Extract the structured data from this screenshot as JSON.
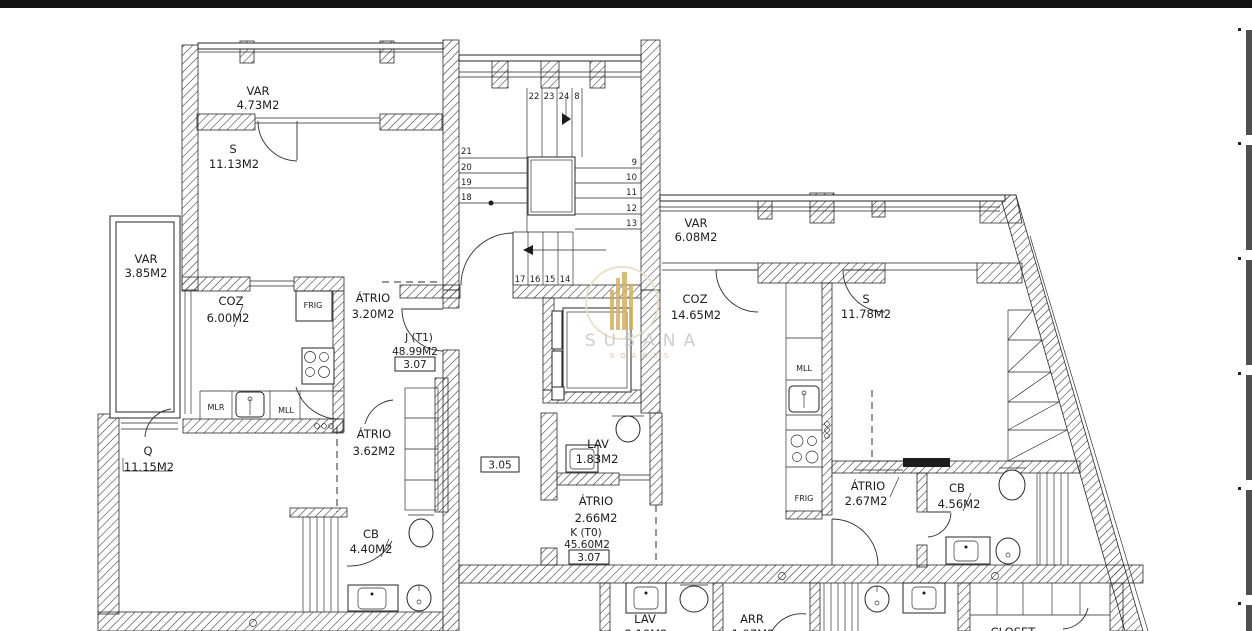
{
  "frame": {
    "top_bar_color": "#131313",
    "edge_mark_color": "#4f4f4f"
  },
  "watermark": {
    "name": "SUSANA",
    "subname": "SOARES",
    "accent": "#d2b263",
    "ring": "#e6dcc2",
    "text_color": "#bfbfbf"
  },
  "units": {
    "j": {
      "label": "J (T1)",
      "area": "48.99M2",
      "door_tag": "3.07"
    },
    "k": {
      "label": "K (T0)",
      "area": "45.60M2",
      "door_tag": "3.07"
    }
  },
  "corridor": {
    "door_tag": "3.05"
  },
  "rooms": {
    "var_top_left": {
      "name": "VAR",
      "area": "4.73M2"
    },
    "s_top_left": {
      "name": "S",
      "area": "11.13M2"
    },
    "var_left": {
      "name": "VAR",
      "area": "3.85M2"
    },
    "coz_left": {
      "name": "COZ",
      "area": "6.00M2"
    },
    "atrio_entry_left": {
      "name": "ÁTRIO",
      "area": "3.20M2"
    },
    "q_left": {
      "name": "Q",
      "area": "11.15M2"
    },
    "atrio_inner_left": {
      "name": "ÁTRIO",
      "area": "3.62M2"
    },
    "cb_left": {
      "name": "CB",
      "area": "4.40M2"
    },
    "var_right": {
      "name": "VAR",
      "area": "6.08M2"
    },
    "coz_right": {
      "name": "COZ",
      "area": "14.65M2"
    },
    "s_right": {
      "name": "S",
      "area": "11.78M2"
    },
    "lav_center": {
      "name": "LAV",
      "area": "1.83M2"
    },
    "atrio_center": {
      "name": "ÁTRIO",
      "area": "2.66M2"
    },
    "atrio_right": {
      "name": "ÁTRIO",
      "area": "2.67M2"
    },
    "cb_right": {
      "name": "CB",
      "area": "4.56M2"
    },
    "lav_bottom": {
      "name": "LAV",
      "area": "2.18M2"
    },
    "arr_bottom": {
      "name": "ARR",
      "area": "1.97M2"
    },
    "closet_bottom": {
      "name": "CLOSET",
      "area": ""
    }
  },
  "appliances": {
    "frig_left": "FRIG",
    "frig_right": "FRIG",
    "mlr": "MLR",
    "mll_left": "MLL",
    "mll_right": "MLL"
  },
  "stairs": {
    "top": [
      "22",
      "23",
      "24",
      "8"
    ],
    "left": [
      "21",
      "20",
      "19",
      "18"
    ],
    "right": [
      "9",
      "10",
      "11",
      "12",
      "13"
    ],
    "bottom": [
      "17",
      "16",
      "15",
      "14"
    ]
  }
}
